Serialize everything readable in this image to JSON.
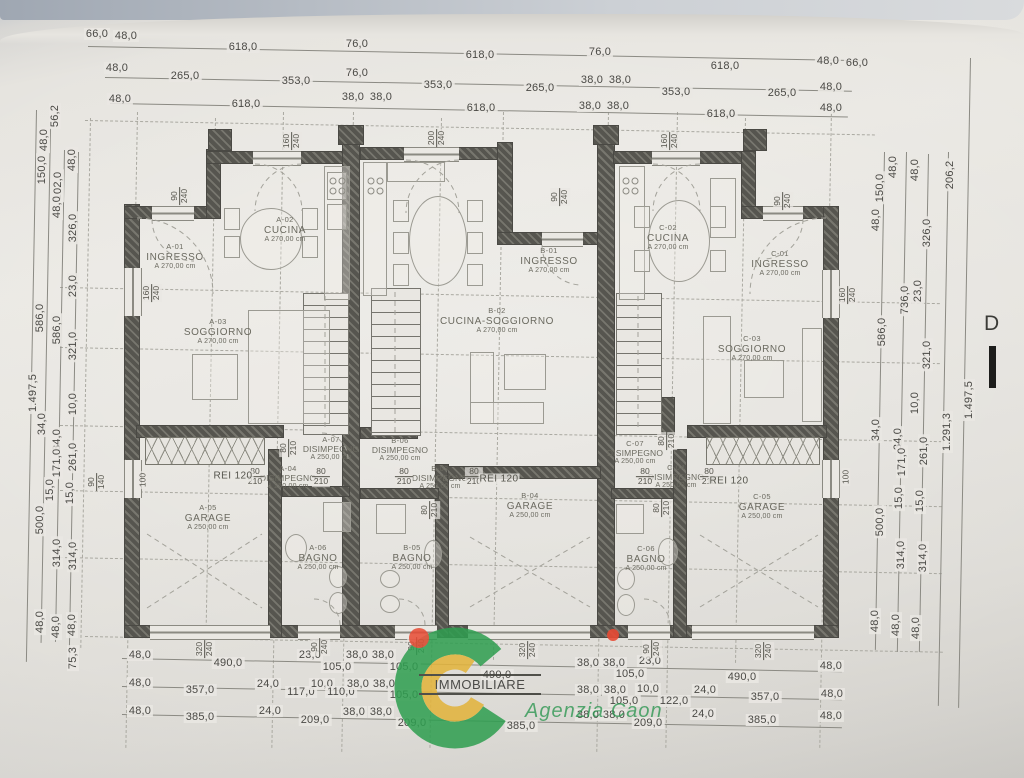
{
  "colors": {
    "paper": "#e9e7e2",
    "wall": "#56554f",
    "dim_line": "#8b8a83",
    "dim_text": "#4a4945",
    "room_text": "#6b6a60",
    "logo_green": "#2e9e50",
    "logo_yellow": "#e2b33c",
    "logo_red": "#e84a33"
  },
  "logo": {
    "brand": "IMMOBILIARE",
    "agency": "Agenzia Caon"
  },
  "section_label": "D",
  "rooms": [
    {
      "id": "A-01",
      "name": "INGRESSO",
      "h": "A 270,00 cm",
      "x": 175,
      "y": 257,
      "s": 0
    },
    {
      "id": "A-02",
      "name": "CUCINA",
      "h": "A 270,00 cm",
      "x": 285,
      "y": 230,
      "s": 0
    },
    {
      "id": "A-03",
      "name": "SOGGIORNO",
      "h": "A 270,00 cm",
      "x": 218,
      "y": 332,
      "s": 0
    },
    {
      "id": "A-07",
      "name": "DISIMPEGNO",
      "h": "A 250,00 cm",
      "x": 331,
      "y": 449,
      "s": 1
    },
    {
      "id": "A-04",
      "name": "DISIMPEGNO",
      "h": "A 250,00 cm",
      "x": 288,
      "y": 478,
      "s": 1
    },
    {
      "id": "A-05",
      "name": "GARAGE",
      "h": "A 250,00 cm",
      "x": 208,
      "y": 518,
      "s": 0
    },
    {
      "id": "A-06",
      "name": "BAGNO",
      "h": "A 250,00 cm",
      "x": 318,
      "y": 558,
      "s": 0
    },
    {
      "id": "B-01",
      "name": "INGRESSO",
      "h": "A 270,00 cm",
      "x": 549,
      "y": 261,
      "s": 0
    },
    {
      "id": "B-02",
      "name": "CUCINA-SOGGIORNO",
      "h": "A 270,00 cm",
      "x": 497,
      "y": 321,
      "s": 0
    },
    {
      "id": "B-06",
      "name": "DISIMPEGNO",
      "h": "A 250,00 cm",
      "x": 400,
      "y": 450,
      "s": 1
    },
    {
      "id": "B-03",
      "name": "DISIMPEGNO",
      "h": "A 250,00 cm",
      "x": 440,
      "y": 478,
      "s": 1
    },
    {
      "id": "B-04",
      "name": "GARAGE",
      "h": "A 250,00 cm",
      "x": 530,
      "y": 506,
      "s": 0
    },
    {
      "id": "B-05",
      "name": "BAGNO",
      "h": "A 250,00 cm",
      "x": 412,
      "y": 558,
      "s": 0
    },
    {
      "id": "C-01",
      "name": "INGRESSO",
      "h": "A 270,00 cm",
      "x": 780,
      "y": 264,
      "s": 0
    },
    {
      "id": "C-02",
      "name": "CUCINA",
      "h": "A 270,00 cm",
      "x": 668,
      "y": 238,
      "s": 0
    },
    {
      "id": "C-03",
      "name": "SOGGIORNO",
      "h": "A 270,00 cm",
      "x": 752,
      "y": 349,
      "s": 0
    },
    {
      "id": "C-07",
      "name": "DISIMPEGNO",
      "h": "A 250,00 cm",
      "x": 635,
      "y": 453,
      "s": 1
    },
    {
      "id": "C-04",
      "name": "DISIMPEGNO",
      "h": "A 250,00 cm",
      "x": 676,
      "y": 477,
      "s": 1
    },
    {
      "id": "C-05",
      "name": "GARAGE",
      "h": "A 250,00 cm",
      "x": 762,
      "y": 507,
      "s": 0
    },
    {
      "id": "C-06",
      "name": "BAGNO",
      "h": "A 250,00 cm",
      "x": 646,
      "y": 559,
      "s": 0
    }
  ],
  "fire_labels": [
    {
      "t": "REI 120",
      "x": 233,
      "y": 476
    },
    {
      "t": "REI 120",
      "x": 499,
      "y": 479
    },
    {
      "t": "REI 120",
      "x": 729,
      "y": 481
    }
  ],
  "opening_labels": [
    {
      "a": "160",
      "b": "240",
      "x": 292,
      "y": 141,
      "rot": 1
    },
    {
      "a": "90",
      "b": "240",
      "x": 180,
      "y": 196,
      "rot": 1
    },
    {
      "a": "200",
      "b": "240",
      "x": 437,
      "y": 138,
      "rot": 1
    },
    {
      "a": "90",
      "b": "240",
      "x": 560,
      "y": 197,
      "rot": 1
    },
    {
      "a": "160",
      "b": "240",
      "x": 670,
      "y": 141,
      "rot": 1
    },
    {
      "a": "90",
      "b": "240",
      "x": 783,
      "y": 201,
      "rot": 1
    },
    {
      "a": "160",
      "b": "240",
      "x": 848,
      "y": 295,
      "rot": 1
    },
    {
      "a": "160",
      "b": "240",
      "x": 152,
      "y": 293,
      "rot": 1
    },
    {
      "a": "90",
      "b": "140",
      "x": 97,
      "y": 482,
      "rot": 1
    },
    {
      "a": "100",
      "b": "",
      "x": 846,
      "y": 477,
      "rot": 1
    },
    {
      "a": "100",
      "b": "",
      "x": 143,
      "y": 480,
      "rot": 1
    },
    {
      "a": "80",
      "b": "210",
      "x": 289,
      "y": 448,
      "rot": 1
    },
    {
      "a": "80",
      "b": "210",
      "x": 430,
      "y": 510,
      "rot": 1
    },
    {
      "a": "80",
      "b": "210",
      "x": 667,
      "y": 441,
      "rot": 1
    },
    {
      "a": "80",
      "b": "210",
      "x": 662,
      "y": 508,
      "rot": 1
    },
    {
      "a": "80",
      "b": "210",
      "x": 255,
      "y": 477,
      "rot": 0
    },
    {
      "a": "80",
      "b": "210",
      "x": 321,
      "y": 477,
      "rot": 0
    },
    {
      "a": "80",
      "b": "210",
      "x": 404,
      "y": 477,
      "rot": 0
    },
    {
      "a": "80",
      "b": "210",
      "x": 474,
      "y": 477,
      "rot": 0
    },
    {
      "a": "80",
      "b": "210",
      "x": 645,
      "y": 477,
      "rot": 0
    },
    {
      "a": "80",
      "b": "210",
      "x": 709,
      "y": 477,
      "rot": 0
    },
    {
      "a": "320",
      "b": "240",
      "x": 205,
      "y": 649,
      "rot": 1
    },
    {
      "a": "90",
      "b": "240",
      "x": 320,
      "y": 647,
      "rot": 1
    },
    {
      "a": "90",
      "b": "240",
      "x": 417,
      "y": 646,
      "rot": 1
    },
    {
      "a": "320",
      "b": "240",
      "x": 528,
      "y": 650,
      "rot": 1
    },
    {
      "a": "90",
      "b": "240",
      "x": 652,
      "y": 649,
      "rot": 1
    },
    {
      "a": "320",
      "b": "240",
      "x": 764,
      "y": 651,
      "rot": 1
    }
  ],
  "dims_top": [
    {
      "t": "66,0",
      "x": 97,
      "y": 34
    },
    {
      "t": "48,0",
      "x": 126,
      "y": 36
    },
    {
      "t": "618,0",
      "x": 243,
      "y": 47
    },
    {
      "t": "76,0",
      "x": 357,
      "y": 44
    },
    {
      "t": "618,0",
      "x": 480,
      "y": 55
    },
    {
      "t": "76,0",
      "x": 600,
      "y": 52
    },
    {
      "t": "618,0",
      "x": 725,
      "y": 66
    },
    {
      "t": "48,0",
      "x": 828,
      "y": 61
    },
    {
      "t": "66,0",
      "x": 857,
      "y": 63
    },
    {
      "t": "48,0",
      "x": 117,
      "y": 68
    },
    {
      "t": "265,0",
      "x": 185,
      "y": 76
    },
    {
      "t": "353,0",
      "x": 296,
      "y": 81
    },
    {
      "t": "76,0",
      "x": 357,
      "y": 73
    },
    {
      "t": "353,0",
      "x": 438,
      "y": 85
    },
    {
      "t": "265,0",
      "x": 540,
      "y": 88
    },
    {
      "t": "38,0",
      "x": 592,
      "y": 80
    },
    {
      "t": "38,0",
      "x": 620,
      "y": 80
    },
    {
      "t": "353,0",
      "x": 676,
      "y": 92
    },
    {
      "t": "265,0",
      "x": 782,
      "y": 93
    },
    {
      "t": "48,0",
      "x": 831,
      "y": 87
    },
    {
      "t": "48,0",
      "x": 120,
      "y": 99
    },
    {
      "t": "618,0",
      "x": 246,
      "y": 104
    },
    {
      "t": "38,0",
      "x": 353,
      "y": 97
    },
    {
      "t": "38,0",
      "x": 381,
      "y": 97
    },
    {
      "t": "618,0",
      "x": 481,
      "y": 108
    },
    {
      "t": "38,0",
      "x": 590,
      "y": 106
    },
    {
      "t": "38,0",
      "x": 618,
      "y": 106
    },
    {
      "t": "618,0",
      "x": 721,
      "y": 114
    },
    {
      "t": "48,0",
      "x": 831,
      "y": 108
    }
  ],
  "dims_bottom": [
    {
      "t": "48,0",
      "x": 140,
      "y": 655
    },
    {
      "t": "490,0",
      "x": 228,
      "y": 663
    },
    {
      "t": "23,0",
      "x": 310,
      "y": 655
    },
    {
      "t": "105,0",
      "x": 337,
      "y": 667
    },
    {
      "t": "38,0",
      "x": 357,
      "y": 655
    },
    {
      "t": "38,0",
      "x": 383,
      "y": 655
    },
    {
      "t": "105,0",
      "x": 404,
      "y": 667
    },
    {
      "t": "490,0",
      "x": 497,
      "y": 675
    },
    {
      "t": "38,0",
      "x": 588,
      "y": 663
    },
    {
      "t": "38,0",
      "x": 614,
      "y": 663
    },
    {
      "t": "23,0",
      "x": 650,
      "y": 661
    },
    {
      "t": "105,0",
      "x": 630,
      "y": 674
    },
    {
      "t": "490,0",
      "x": 742,
      "y": 677
    },
    {
      "t": "48,0",
      "x": 831,
      "y": 666
    },
    {
      "t": "48,0",
      "x": 140,
      "y": 683
    },
    {
      "t": "357,0",
      "x": 200,
      "y": 690
    },
    {
      "t": "24,0",
      "x": 268,
      "y": 684
    },
    {
      "t": "117,0",
      "x": 301,
      "y": 692
    },
    {
      "t": "10,0",
      "x": 322,
      "y": 684
    },
    {
      "t": "110,0",
      "x": 341,
      "y": 692
    },
    {
      "t": "38,0",
      "x": 358,
      "y": 684
    },
    {
      "t": "38,0",
      "x": 384,
      "y": 684
    },
    {
      "t": "105,0",
      "x": 404,
      "y": 695
    },
    {
      "t": "38,0",
      "x": 588,
      "y": 690
    },
    {
      "t": "38,0",
      "x": 615,
      "y": 690
    },
    {
      "t": "10,0",
      "x": 648,
      "y": 689
    },
    {
      "t": "105,0",
      "x": 624,
      "y": 701
    },
    {
      "t": "122,0",
      "x": 674,
      "y": 701
    },
    {
      "t": "24,0",
      "x": 705,
      "y": 690
    },
    {
      "t": "357,0",
      "x": 765,
      "y": 697
    },
    {
      "t": "48,0",
      "x": 832,
      "y": 694
    },
    {
      "t": "48,0",
      "x": 140,
      "y": 711
    },
    {
      "t": "385,0",
      "x": 200,
      "y": 717
    },
    {
      "t": "24,0",
      "x": 270,
      "y": 711
    },
    {
      "t": "209,0",
      "x": 315,
      "y": 720
    },
    {
      "t": "38,0",
      "x": 354,
      "y": 712
    },
    {
      "t": "38,0",
      "x": 381,
      "y": 712
    },
    {
      "t": "209,0",
      "x": 412,
      "y": 723
    },
    {
      "t": "385,0",
      "x": 521,
      "y": 726
    },
    {
      "t": "38,0",
      "x": 588,
      "y": 715
    },
    {
      "t": "38,0",
      "x": 614,
      "y": 715
    },
    {
      "t": "209,0",
      "x": 648,
      "y": 723
    },
    {
      "t": "24,0",
      "x": 703,
      "y": 714
    },
    {
      "t": "385,0",
      "x": 762,
      "y": 720
    },
    {
      "t": "48,0",
      "x": 831,
      "y": 716
    }
  ],
  "dims_left": [
    {
      "t": "1.497,5",
      "x": 33,
      "y": 393
    },
    {
      "t": "56,2",
      "x": 55,
      "y": 116
    },
    {
      "t": "48,0",
      "x": 44,
      "y": 140
    },
    {
      "t": "150,0",
      "x": 42,
      "y": 170
    },
    {
      "t": "102,0",
      "x": 58,
      "y": 186
    },
    {
      "t": "48,0",
      "x": 57,
      "y": 207
    },
    {
      "t": "48,0",
      "x": 72,
      "y": 160
    },
    {
      "t": "326,0",
      "x": 73,
      "y": 228
    },
    {
      "t": "23,0",
      "x": 73,
      "y": 286
    },
    {
      "t": "586,0",
      "x": 40,
      "y": 318
    },
    {
      "t": "586,0",
      "x": 57,
      "y": 330
    },
    {
      "t": "321,0",
      "x": 73,
      "y": 346
    },
    {
      "t": "10,0",
      "x": 73,
      "y": 404
    },
    {
      "t": "34,0",
      "x": 42,
      "y": 424
    },
    {
      "t": "34,0",
      "x": 57,
      "y": 440
    },
    {
      "t": "171,0",
      "x": 57,
      "y": 463
    },
    {
      "t": "261,0",
      "x": 73,
      "y": 457
    },
    {
      "t": "15,0",
      "x": 50,
      "y": 490
    },
    {
      "t": "15,0",
      "x": 70,
      "y": 493
    },
    {
      "t": "500,0",
      "x": 40,
      "y": 520
    },
    {
      "t": "314,0",
      "x": 57,
      "y": 553
    },
    {
      "t": "314,0",
      "x": 73,
      "y": 556
    },
    {
      "t": "48,0",
      "x": 40,
      "y": 622
    },
    {
      "t": "48,0",
      "x": 56,
      "y": 627
    },
    {
      "t": "48,0",
      "x": 72,
      "y": 625
    },
    {
      "t": "75,3",
      "x": 73,
      "y": 658
    }
  ],
  "dims_right": [
    {
      "t": "48,0",
      "x": 893,
      "y": 167
    },
    {
      "t": "48,0",
      "x": 915,
      "y": 170
    },
    {
      "t": "150,0",
      "x": 880,
      "y": 188
    },
    {
      "t": "48,0",
      "x": 876,
      "y": 220
    },
    {
      "t": "206,2",
      "x": 950,
      "y": 175
    },
    {
      "t": "326,0",
      "x": 927,
      "y": 233
    },
    {
      "t": "736,0",
      "x": 905,
      "y": 300
    },
    {
      "t": "23,0",
      "x": 918,
      "y": 291
    },
    {
      "t": "586,0",
      "x": 882,
      "y": 332
    },
    {
      "t": "321,0",
      "x": 927,
      "y": 355
    },
    {
      "t": "10,0",
      "x": 915,
      "y": 403
    },
    {
      "t": "1.291,3",
      "x": 947,
      "y": 432
    },
    {
      "t": "1.497,5",
      "x": 969,
      "y": 400
    },
    {
      "t": "34,0",
      "x": 876,
      "y": 430
    },
    {
      "t": "34,0",
      "x": 898,
      "y": 439
    },
    {
      "t": "171,0",
      "x": 902,
      "y": 462
    },
    {
      "t": "261,0",
      "x": 924,
      "y": 451
    },
    {
      "t": "15,0",
      "x": 899,
      "y": 498
    },
    {
      "t": "15,0",
      "x": 920,
      "y": 501
    },
    {
      "t": "500,0",
      "x": 880,
      "y": 522
    },
    {
      "t": "314,0",
      "x": 901,
      "y": 555
    },
    {
      "t": "314,0",
      "x": 923,
      "y": 558
    },
    {
      "t": "48,0",
      "x": 875,
      "y": 621
    },
    {
      "t": "48,0",
      "x": 896,
      "y": 625
    },
    {
      "t": "48,0",
      "x": 916,
      "y": 628
    }
  ]
}
